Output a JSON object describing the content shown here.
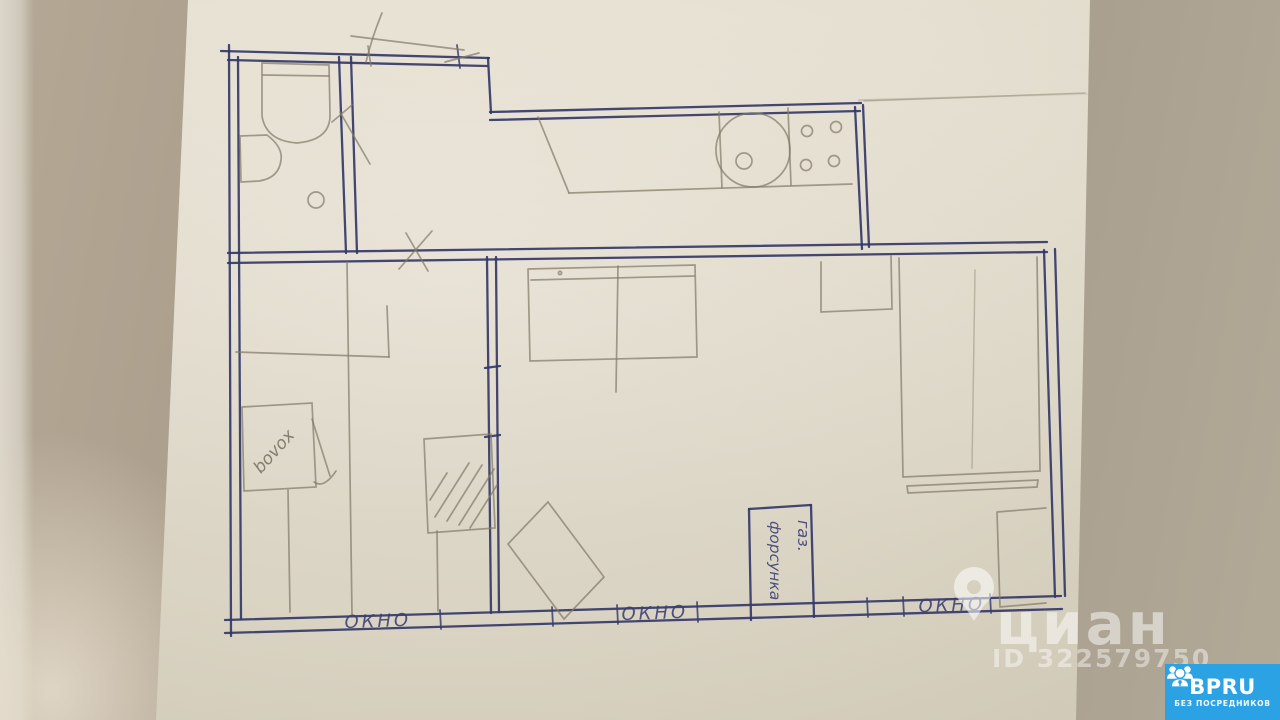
{
  "floorplan": {
    "window_labels": [
      "ОКНО",
      "ОКНО",
      "ОКНО"
    ],
    "gas_box": {
      "line1": "газ.",
      "line2": "форсунка"
    },
    "appliance_label": "bovox",
    "ink_color": "#343868",
    "pencil_color": "#847b69",
    "paper_color": "#e6e0d1",
    "table_color": "#a89b89"
  },
  "watermark": {
    "brand": "циан",
    "listing_id": "ID 322579750",
    "pin_icon": "location-pin-icon"
  },
  "badge": {
    "brand": "BPRU",
    "tagline": "БЕЗ ПОСРЕДНИКОВ",
    "background_color": "#2aa2e3",
    "icon": "people-group-icon"
  }
}
